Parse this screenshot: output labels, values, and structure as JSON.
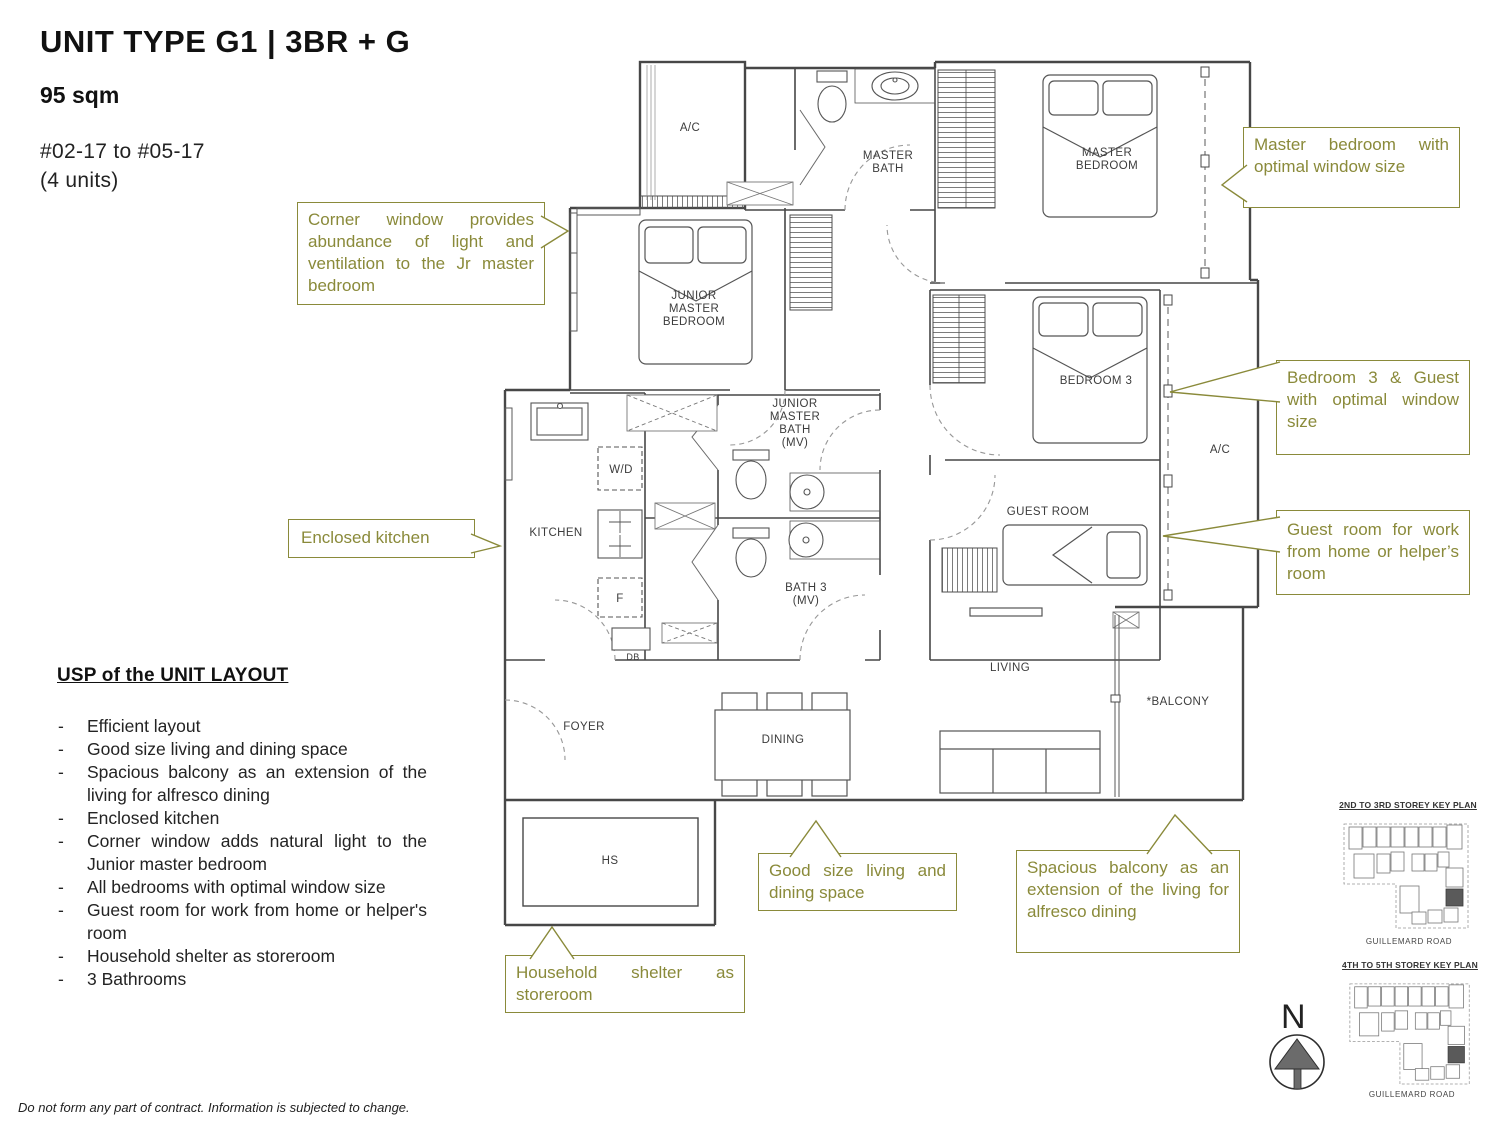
{
  "header": {
    "title": "UNIT TYPE G1 | 3BR + G",
    "area": "95 sqm",
    "units_range": "#02-17 to #05-17",
    "units_count": "(4 units)"
  },
  "usp": {
    "heading": "USP of the UNIT LAYOUT",
    "items": [
      "Efficient layout",
      "Good size living and dining space",
      "Spacious balcony as an extension of the living for alfresco dining",
      "Enclosed kitchen",
      "Corner window adds natural light to the Junior master bedroom",
      "All bedrooms with optimal window size",
      "Guest room for work from home or helper's room",
      "Household shelter as storeroom",
      "3 Bathrooms"
    ]
  },
  "callouts": {
    "master_bedroom": "Master bedroom with optimal window size",
    "corner_window": "Corner window provides abundance of light and ventilation to the Jr master bedroom",
    "bedroom3_guest": "Bedroom 3 & Guest with optimal window size",
    "guest_room": "Guest room for work from home or helper’s room",
    "enclosed_kitchen": "Enclosed kitchen",
    "good_size_living": "Good size living and dining space",
    "spacious_balcony": "Spacious balcony as an extension of the living for alfresco dining",
    "household_shelter": "Household shelter as storeroom"
  },
  "floorplan": {
    "rooms": {
      "ac_top": "A/C",
      "master_bath": "MASTER\nBATH",
      "master_bedroom": "MASTER\nBEDROOM",
      "junior_master_bedroom": "JUNIOR\nMASTER\nBEDROOM",
      "junior_master_bath": "JUNIOR\nMASTER\nBATH\n(MV)",
      "bedroom3": "BEDROOM 3",
      "ac_right": "A/C",
      "guest_room": "GUEST ROOM",
      "wd": "W/D",
      "kitchen": "KITCHEN",
      "fridge": "F",
      "db": "DB",
      "bath3": "BATH 3\n(MV)",
      "living": "LIVING",
      "balcony": "*BALCONY",
      "foyer": "FOYER",
      "dining": "DINING",
      "hs": "HS"
    }
  },
  "keyplans": [
    {
      "title": "2ND TO 3RD STOREY KEY PLAN",
      "road": "GUILLEMARD ROAD"
    },
    {
      "title": "4TH TO 5TH STOREY KEY PLAN",
      "road": "GUILLEMARD ROAD"
    }
  ],
  "compass": {
    "north_label": "N"
  },
  "footer": {
    "disclaimer": "Do not form any part of contract. Information is subjected to change."
  },
  "colors": {
    "accent": "#8A8A3A",
    "plan_line": "#474747",
    "highlight_unit": "#5a5a5a"
  }
}
